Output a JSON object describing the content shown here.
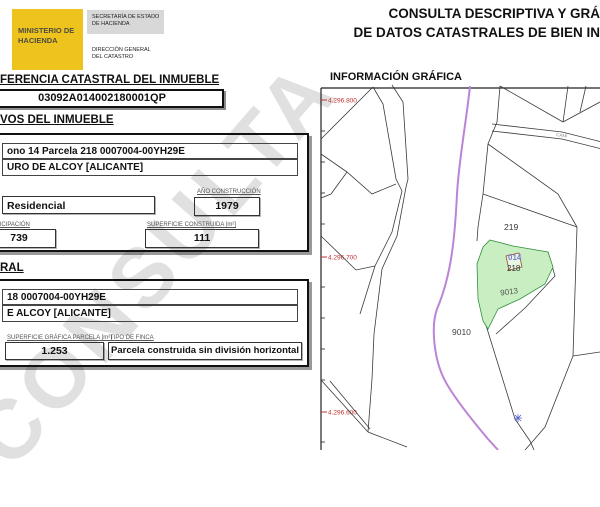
{
  "header": {
    "ministry": "MINISTERIO DE HACIENDA",
    "secretary": "SECRETARÍA DE ESTADO DE HACIENDA",
    "directorate": "DIRECCIÓN GENERAL DEL CATASTRO",
    "title_line1": "CONSULTA DESCRIPTIVA Y GRÁ",
    "title_line2": "DE DATOS CATASTRALES DE BIEN IN"
  },
  "reference": {
    "section_title": "FERENCIA CATASTRAL DEL INMUEBLE",
    "value": "03092A014002180001QP"
  },
  "inmueble": {
    "section_title": "VOS DEL INMUEBLE",
    "location_line1": "ono 14 Parcela 218 0007004-00YH29E",
    "location_line2": "URO DE ALCOY [ALICANTE]",
    "uso_value": "Residencial",
    "ano_construccion_label": "AÑO CONSTRUCCIÓN",
    "ano_construccion_value": "1979",
    "participacion_label": "TICIPACIÓN",
    "participacion_value": "739",
    "superficie_construida_label": "SUPERFICIE CONSTRUIDA [m²]",
    "superficie_construida_value": "111"
  },
  "parcela": {
    "section_title": "RAL",
    "location_line1": "18 0007004-00YH29E",
    "location_line2": "E ALCOY [ALICANTE]",
    "superficie_grafica_label": "SUPERFICIE GRÁFICA PARCELA [m²]",
    "superficie_grafica_value": "1.253",
    "tipo_finca_label": "TIPO DE FINCA",
    "tipo_finca_value": "Parcela construida sin división horizontal"
  },
  "map": {
    "section_title": "INFORMACIÓN GRÁFICA",
    "coordinates": [
      "4.296.800",
      "4.296.700",
      "4.296.600"
    ],
    "parcels": {
      "p219": "219",
      "p014": "014",
      "p218": "218",
      "p9013": "9013",
      "p9010": "9010"
    },
    "road_label": "CAMI",
    "colors": {
      "highlight_fill": "#c9eec2",
      "highlight_stroke": "#2f8f3c",
      "road": "#bb84d6",
      "coordinate_text": "#c23232",
      "parcel_line": "#3a3a3a"
    }
  },
  "watermark": "CONSULTA"
}
